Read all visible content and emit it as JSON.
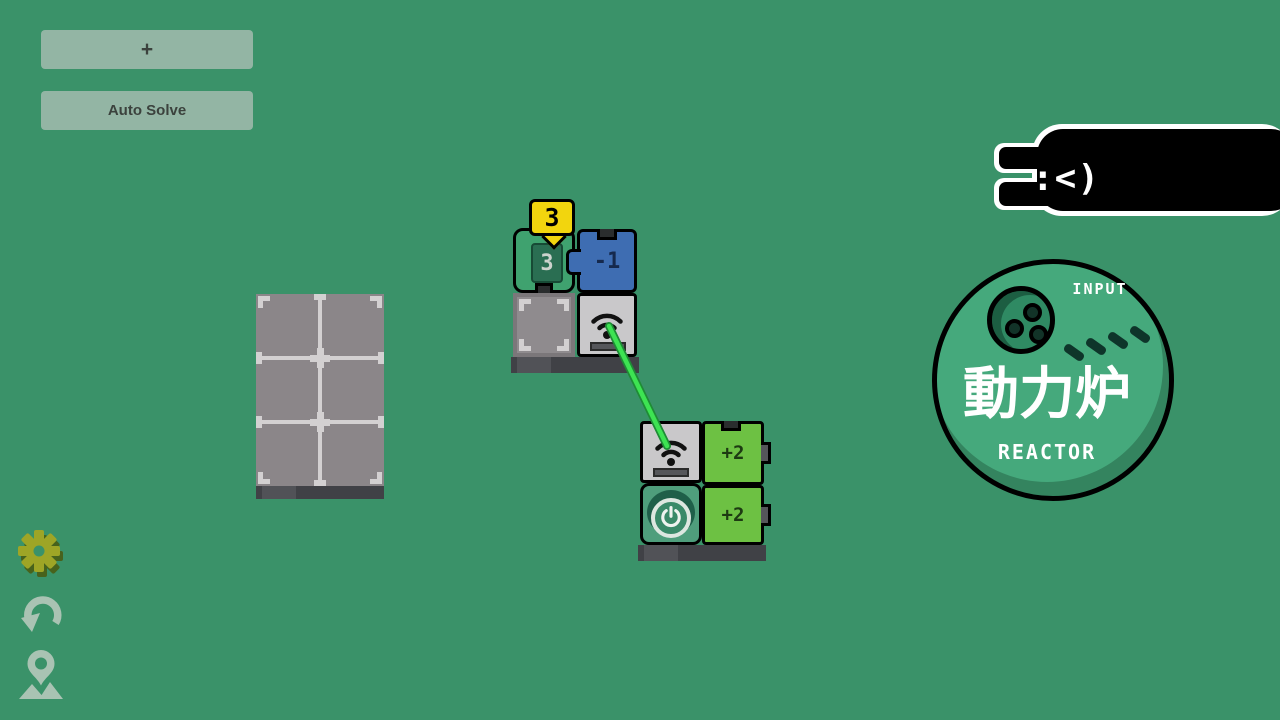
{
  "colors": {
    "background": "#3a9269",
    "button_bg": "#93b5a4",
    "badge_yellow": "#f2d50e",
    "piece_green": "#3fa26f",
    "piece_blue": "#3e6db2",
    "piece_gray": "#c9c8ca",
    "piece_lime": "#6dc143",
    "piece_power_green": "#4f9e7c",
    "beam_green": "#3de352",
    "board_gray": "#8b8689",
    "reactor_green": "#45a97c",
    "gear_olive": "#9ea526",
    "side_icon_gray": "#a9c3b3"
  },
  "toolbar": {
    "add_label": "+",
    "auto_solve_label": "Auto Solve"
  },
  "hud_badge": {
    "value": "3"
  },
  "board": {
    "cols": 2,
    "rows": 3
  },
  "upper_group": {
    "counter_piece": {
      "value": "3"
    },
    "modifier_piece": {
      "value": "-1"
    }
  },
  "lower_group": {
    "plus_top": "+2",
    "plus_bottom": "+2"
  },
  "reactor": {
    "input_label": "INPUT",
    "kanji": "動力炉",
    "label": "REACTOR",
    "dash_count": 4
  },
  "creature": {
    "face": ":<)"
  },
  "icons": {
    "settings": "gear-icon",
    "undo": "undo-icon",
    "location": "map-pin-icon",
    "signal": "wifi-icon",
    "power": "power-icon"
  }
}
